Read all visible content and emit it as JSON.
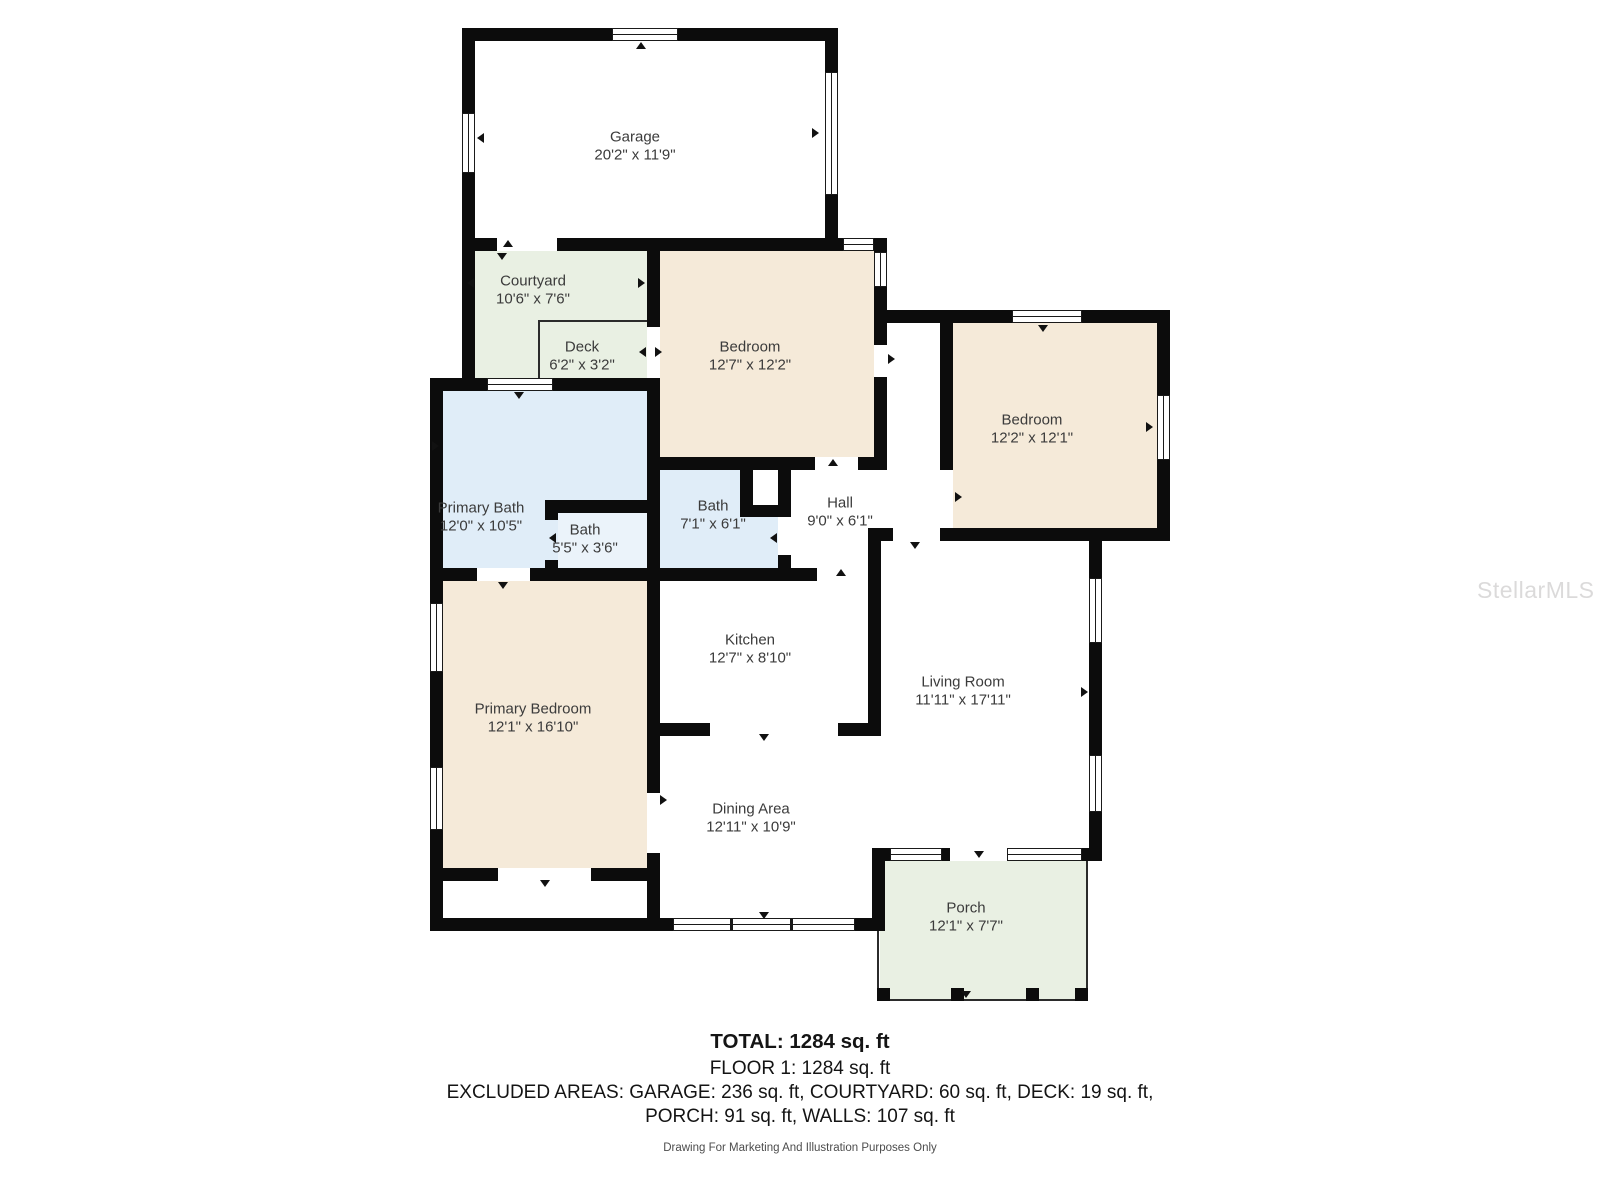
{
  "rooms": {
    "garage": {
      "name": "Garage",
      "dims": "20'2\" x 11'9\""
    },
    "courtyard": {
      "name": "Courtyard",
      "dims": "10'6\" x 7'6\""
    },
    "deck": {
      "name": "Deck",
      "dims": "6'2\" x 3'2\""
    },
    "bedroom_center": {
      "name": "Bedroom",
      "dims": "12'7\" x 12'2\""
    },
    "bedroom_right": {
      "name": "Bedroom",
      "dims": "12'2\" x 12'1\""
    },
    "primary_bath": {
      "name": "Primary Bath",
      "dims": "12'0\" x 10'5\""
    },
    "bath_small": {
      "name": "Bath",
      "dims": "5'5\" x 3'6\""
    },
    "bath": {
      "name": "Bath",
      "dims": "7'1\" x 6'1\""
    },
    "hall": {
      "name": "Hall",
      "dims": "9'0\" x 6'1\""
    },
    "kitchen": {
      "name": "Kitchen",
      "dims": "12'7\" x 8'10\""
    },
    "living_room": {
      "name": "Living Room",
      "dims": "11'11\" x 17'11\""
    },
    "primary_bedroom": {
      "name": "Primary Bedroom",
      "dims": "12'1\" x 16'10\""
    },
    "dining_area": {
      "name": "Dining Area",
      "dims": "12'11\" x 10'9\""
    },
    "porch": {
      "name": "Porch",
      "dims": "12'1\" x 7'7\""
    }
  },
  "summary": {
    "total": "TOTAL: 1284 sq. ft",
    "floor": "FLOOR 1: 1284 sq. ft",
    "excluded_line1": "EXCLUDED AREAS: GARAGE: 236 sq. ft, COURTYARD: 60 sq. ft, DECK: 19 sq. ft,",
    "excluded_line2": "PORCH: 91 sq. ft, WALLS: 107 sq. ft",
    "disclaimer": "Drawing For Marketing And Illustration Purposes Only"
  },
  "watermark": "StellarMLS",
  "colors": {
    "wall": "#0c0c0c",
    "bedroom_fill": "#f5ead9",
    "bath_fill": "#e0edf8",
    "bath_small_fill": "#ebf3fa",
    "outdoor_fill": "#e9f0e3",
    "label_text": "#3b3b3b"
  }
}
